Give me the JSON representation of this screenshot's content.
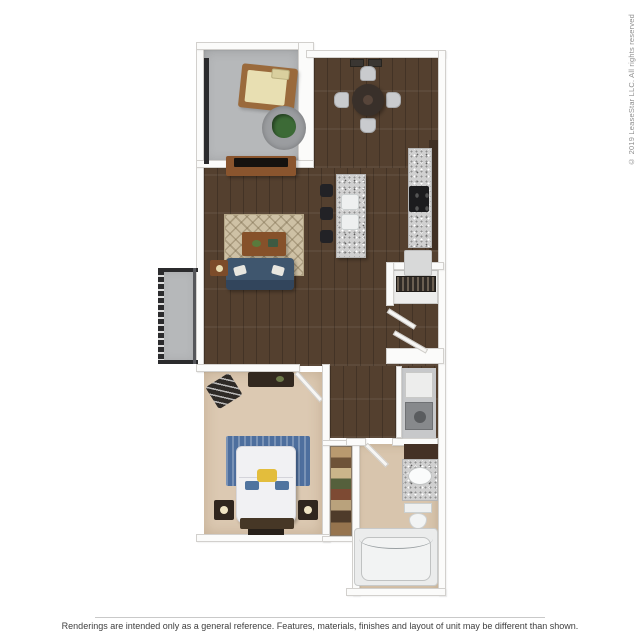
{
  "page": {
    "background": "#ffffff"
  },
  "floorplan": {
    "type": "3d-apartment-floor-plan",
    "rooms": [
      "patio",
      "dining-area",
      "kitchen",
      "living-room",
      "entry-closet",
      "hallway",
      "laundry-closet",
      "bedroom",
      "walk-in-closet",
      "bathroom",
      "exterior-landing"
    ]
  },
  "watermark": {
    "copyright": "© 2019 LeaseStar LLC. All rights reserved"
  },
  "footer": {
    "disclaimer": "Renderings are intended only as a general reference. Features, materials, finishes and layout of unit may be different than shown."
  },
  "colors": {
    "page-bg": "#ffffff",
    "wood": "#54402f",
    "wood-dark": "#3f2f23",
    "carpet": "#dcc9b2",
    "tile": "#d8c5ad",
    "concrete": "#b6b8ba",
    "wall": "#fbfbfa",
    "wall-border": "#d2d0cd",
    "granite": "#d0d0d0",
    "couch": "#3f566e",
    "rug": "#cec1a5",
    "accent-wood": "#8a552e",
    "dark-furniture": "#32281f",
    "stool": "#222226",
    "bed": "#f1f1f3",
    "headboard": "#4e6f9e",
    "pillow-yellow": "#e3bd3c",
    "plant": "#3c6a36",
    "railing": "#2b2b2d",
    "fixture": "#eef0f0",
    "appliance": "#87898c",
    "text": "#3f3f3f",
    "muted-text": "#8f8f8f",
    "divider": "#c9c9c9"
  }
}
